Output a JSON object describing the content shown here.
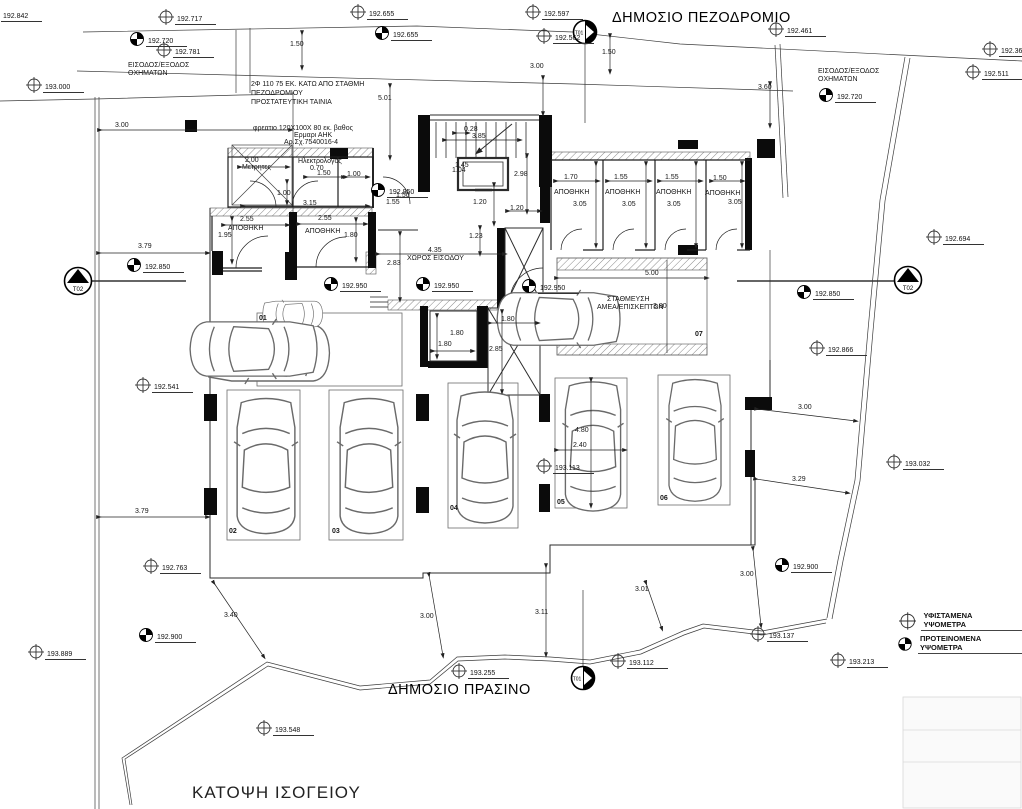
{
  "drawing": {
    "title": "ΚΑΤΟΨΗ ΙΣΟΓΕΙΟΥ",
    "public_sidewalk": "ΔΗΜΟΣΙΟ ΠΕΖΟΔΡΟΜΙΟ",
    "public_green": "ΔΗΜΟΣΙΟ ΠΡΑΣΙΝΟ",
    "vehicle_access_1": "ΕΙΣΟΔΟΣ/ΕΞΟΔΟΣ",
    "vehicle_access_2": "ΟΧΗΜΑΤΩΝ"
  },
  "notes": {
    "pipe_line1": "2Φ 110  75 ΕΚ. ΚΑΤΩ ΑΠΟ ΣΤΑΘΜΗ",
    "pipe_line2": "ΠΕΖΟΔΡΟΜΙΟΥ",
    "pipe_line3": "ΠΡΟΣΤΑΤΕΥΤΙΚΗ ΤΑΙΝΙΑ",
    "manhole_line1": "φρεατιο 120Χ100Χ 80 εκ. βαθος",
    "manhole_line2": "Ερμαρι ΑΗΚ",
    "manhole_line3": "Αρ.Σχ.7540016-4"
  },
  "rooms": {
    "meters_label": "Μετρητες",
    "meters_width": "2.00",
    "electrician_label": "Ηλεκτρολογος",
    "electrician_width": "0.70",
    "storage_label": "ΑΠΟΘΗΚΗ",
    "sl1_w": "2.55",
    "sl1_d": "1.95",
    "sl2_w": "2.55",
    "sl2_d": "1.80",
    "sr1_w": "1.70",
    "sr2_w": "1.55",
    "sr3_w": "1.55",
    "sr4_w": "1.50",
    "sr_depth": "3.05",
    "hall_label": "ΧΩΡΟΣ ΕΙΣΟΔΟΥ",
    "hall_w": "4.35",
    "hall_d": "2.83"
  },
  "parking": {
    "n1": "01",
    "n2": "02",
    "n3": "03",
    "n4": "04",
    "n5": "05",
    "n6": "06",
    "n7": "07",
    "amea_line1": "ΣΤΑΘΜΕΥΣΗ",
    "amea_line2": "ΑΜΕΑ/ΕΠΙΣΚΕΠΤΩΝ",
    "amea_width": "5.00",
    "amea_length": "3.80",
    "space_length": "4.80",
    "space_width": "2.40"
  },
  "benchmarks": {
    "t01": "T01",
    "t02": "T02"
  },
  "legend": {
    "existing": "ΥΦΙΣΤΑΜΕΝΑ ΥΨΟΜΕΤΡΑ",
    "proposed": "ΠΡΟΤΕΙΝΟΜΕΝΑ ΥΨΟΜΕΤΡΑ"
  },
  "elevations_existing": [
    "192.842",
    "192.717",
    "192.655",
    "192.597",
    "192.562",
    "192.461",
    "192.366",
    "192.511",
    "193.000",
    "192.781",
    "192.694",
    "192.541",
    "192.866",
    "193.032",
    "192.763",
    "193.889",
    "193.255",
    "193.112",
    "193.137",
    "193.213",
    "193.548",
    "193.113"
  ],
  "elevations_proposed": [
    "192.720",
    "192.720",
    "192.655",
    "192.950",
    "192.950",
    "192.950",
    "192.950",
    "192.850",
    "192.850",
    "192.900",
    "192.900"
  ],
  "dims": {
    "top_left_150": "1.50",
    "left_300": "3.00",
    "top_mid_300": "3.00",
    "top_mid_150": "1.50",
    "top_right_360": "3.60",
    "stair_501": "5.01",
    "stair_028": "0.28",
    "stair_385": "3.85",
    "elev_145": "1.45",
    "elev_104": "1.04",
    "core_298": "2.98",
    "core_120a": "1.20",
    "core_120b": "1.20",
    "core_123": "1.23",
    "elec_150": "1.50",
    "elec_100": "1.00",
    "meters_100": "1.00",
    "meters_315": "3.15",
    "mid_150": "1.50",
    "mid_155": "1.55",
    "lw_180a": "1.80",
    "lw_180b": "1.80",
    "lw_180c": "1.80",
    "lw_285": "2.85",
    "left_379a": "3.79",
    "left_379b": "3.79",
    "right_300": "3.00",
    "right_329": "3.29",
    "bot_340": "3.40",
    "bot_300a": "3.00",
    "bot_311": "3.11",
    "bot_301": "3.01",
    "bot_300b": "3.00",
    "p5_193113": "193.113"
  }
}
